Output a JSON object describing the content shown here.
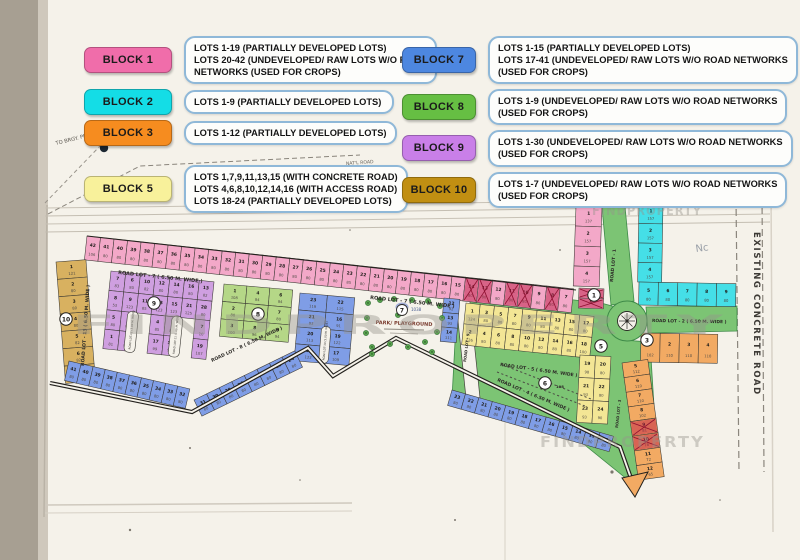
{
  "legend": {
    "left": [
      {
        "block": "BLOCK 1",
        "color": "#f06daa",
        "lines": [
          "LOTS 1-19  (PARTIALLY DEVELOPED LOTS)",
          "LOTS 20-42 (UNDEVELOPED/ RAW LOTS W/O ROAD",
          "NETWORKS (USED FOR CROPS)"
        ]
      },
      {
        "block": "BLOCK 2",
        "color": "#14dde6",
        "lines": [
          "LOTS 1-9   (PARTIALLY DEVELOPED LOTS)"
        ]
      },
      {
        "block": "BLOCK 3",
        "color": "#f68c1f",
        "lines": [
          "LOTS 1-12  (PARTIALLY DEVELOPED LOTS)"
        ]
      },
      {
        "block": "BLOCK 5",
        "color": "#f8f19b",
        "lines": [
          "LOTS 1,7,9,11,13,15 (WITH CONCRETE ROAD)",
          "LOTS 4,6,8,10,12,14,16 (WITH ACCESS ROAD)",
          "LOTS 18-24 (PARTIALLY DEVELOPED LOTS)"
        ]
      }
    ],
    "right": [
      {
        "block": "BLOCK 7",
        "color": "#4d87e0",
        "lines": [
          "LOTS 1-15  (PARTIALLY DEVELOPED LOTS)",
          "LOTS 17-41 (UNDEVELOPED/ RAW LOTS W/O ROAD NETWORKS",
          "(USED FOR CROPS)"
        ]
      },
      {
        "block": "BLOCK 8",
        "color": "#66bf43",
        "lines": [
          "LOTS 1-9 (UNDEVELOPED/ RAW LOTS W/O ROAD NETWORKS",
          "(USED FOR CROPS)"
        ]
      },
      {
        "block": "BLOCK 9",
        "color": "#c97fe8",
        "lines": [
          "LOTS 1-30 (UNDEVELOPED/ RAW LOTS W/O ROAD NETWORKS",
          "(USED FOR CROPS)"
        ]
      },
      {
        "block": "BLOCK 10",
        "color": "#c18f12",
        "lines": [
          "LOTS 1-7 (UNDEVELOPED/ RAW LOTS W/O ROAD NETWORKS",
          "(USED FOR CROPS)"
        ]
      }
    ]
  },
  "map": {
    "labels": {
      "road_lot_1": "ROAD LOT - 1",
      "road_lot_2": "ROAD LOT - 2  ( 6.50 M. WIDE )",
      "road_lot_3": "ROAD LOT - 3",
      "road_lot_4": "ROAD LOT - 4  ( 6.50 M. WIDE )",
      "road_lot_5": "ROAD LOT - 5  ( 6.50 M. WIDE )",
      "road_lot_7": "ROAD LOT - 7  ( 6.50 M. WIDE )",
      "road_lot_8": "ROAD LOT - 8  ( 6.50 M. WIDE )",
      "road_lot_9": "ROAD LOT - 9",
      "road_lot_10": "ROAD LOT-10 (3.00 M. WIDE)",
      "road_lot_11": "ROAD LOT-11 (3.00 M. WIDE)",
      "road_lot_12": "ROAD LOT-12 (3.00 M. WIDE)",
      "road_lot_13": "ROAD LOT - 13  ( 6.50 M. WIDE )",
      "existing_road": "EXISTING CONCRETE ROAD",
      "national_road": "NAT'L ROAD",
      "to_proper": "TO BRGY. PROPER",
      "park": "PARK/ PLAYGROUND",
      "park_area": "1038",
      "access_area": "108",
      "pencil_note": "Nc",
      "watermark": "FINDPROPERTY"
    },
    "circles": {
      "block1": "1",
      "block3": "3",
      "block5": "5",
      "block6": "6",
      "block7": "7",
      "block8": "8",
      "block9": "9",
      "block10": "10"
    },
    "block_colors": {
      "1": "#f3a8c8",
      "2": "#45dfe7",
      "3": "#f2aa63",
      "5": "#f3e695",
      "7": "#7f9de6",
      "8": "#b5d787",
      "9": "#cf9fe0",
      "10": "#d8b160"
    },
    "road_green": "#7cc474",
    "strips": [
      {
        "id": "pink-top",
        "block": "1",
        "lots": [
          "42|106",
          "41|80",
          "40|80",
          "39|80",
          "38|80",
          "37|80",
          "36|80",
          "35|80",
          "34|80",
          "33|80",
          "32|80",
          "31|80",
          "30|80",
          "29|80",
          "28|80",
          "27|80",
          "26|80",
          "25|80",
          "24|80",
          "23|85",
          "22|80",
          "21|80",
          "20|80",
          "19|80",
          "18|80",
          "17|80",
          "16|80",
          "15|80",
          "14|80",
          "13|80",
          "12|80",
          "11|80",
          "10|80",
          "9|80",
          "8|80",
          "7|80"
        ],
        "marked": [
          "14",
          "13",
          "11",
          "10",
          "8"
        ]
      },
      {
        "id": "pink-col",
        "block": "1",
        "lots": [
          "1|137",
          "2|157",
          "3|157",
          "4|157"
        ]
      },
      {
        "id": "pink-col-sm",
        "block": "1",
        "lots": [
          "5|",
          "6|"
        ],
        "marked": [
          "5",
          "6"
        ]
      },
      {
        "id": "gold-col",
        "block": "10",
        "lots": [
          "1|121",
          "2|80",
          "3|80",
          "4|80",
          "5|82",
          "6|82",
          "7|80"
        ]
      },
      {
        "id": "purple",
        "block": "9",
        "rows": [
          [
            "7|83",
            "6|80",
            "10|82",
            "12|80",
            "14|80",
            "16|80",
            "13|82"
          ],
          [
            "8|53",
            "9|123",
            "11|85",
            "13|123",
            "15|123",
            "21|125",
            "28|80"
          ],
          [
            "5|80",
            "3|85",
            null,
            "4|85",
            "6|85",
            null,
            "7|10"
          ],
          [
            "1|81",
            "2|99",
            null,
            "17|99",
            "18|99",
            null,
            "19|107"
          ]
        ]
      },
      {
        "id": "green8",
        "block": "8",
        "rows": [
          [
            "1|108",
            "4|84",
            "6|84"
          ],
          [
            "2|80",
            "5|111",
            "7|80"
          ],
          [
            "3|100",
            "8|96",
            "9|94"
          ]
        ]
      },
      {
        "id": "blue-park",
        "block": "7",
        "rows": [
          [
            "23|119",
            "22|115"
          ],
          [
            "21|93",
            "16|91"
          ],
          [
            "20|113",
            "19|122"
          ],
          [
            "18|122",
            "17|109"
          ]
        ]
      },
      {
        "id": "park-right",
        "block": "7",
        "lots": [
          "12|92",
          "13|93",
          "14|111"
        ]
      },
      {
        "id": "yellow-main",
        "block": "5",
        "rows": [
          [
            "1|124",
            "3|80",
            "5|80",
            "7|80",
            "9|80",
            "11|80",
            "13|80",
            "15|80",
            "17|80"
          ],
          [
            "2|126",
            "4|80",
            "6|80",
            "8|80",
            "10|80",
            "12|80",
            "14|80",
            "16|80",
            "18|100"
          ]
        ]
      },
      {
        "id": "yellow-col",
        "block": "5",
        "rows": [
          [
            "19|98",
            "20|80"
          ],
          [
            "21|93",
            "22|80"
          ],
          [
            "23|93",
            "24|90"
          ]
        ]
      },
      {
        "id": "blue-right",
        "block": "7",
        "lots": [
          "23|80",
          "22|80",
          "21|80",
          "20|80",
          "19|80",
          "18|80",
          "17|80",
          "16|80",
          "15|80",
          "14|80",
          "13|80",
          "12|80"
        ]
      },
      {
        "id": "blue-bl",
        "block": "7",
        "lots": [
          "41|80",
          "40|80",
          "39|80",
          "38|80",
          "37|80",
          "36|80",
          "35|80",
          "34|80",
          "33|80",
          "32|80"
        ]
      },
      {
        "id": "blue-rise",
        "block": "7",
        "lots": [
          "31|80",
          "30|80",
          "29|80",
          "28|80",
          "27|80",
          "26|80",
          "25|80",
          "24|80"
        ]
      },
      {
        "id": "cyan-col",
        "block": "2",
        "lots": [
          "1|157",
          "2|157",
          "3|157",
          "4|157"
        ]
      },
      {
        "id": "cyan-row",
        "block": "2",
        "lots": [
          "5|80",
          "6|80",
          "7|80",
          "8|80",
          "9|80"
        ]
      },
      {
        "id": "orange-row",
        "block": "3",
        "lots": [
          "1|102",
          "2|110",
          "3|110",
          "4|110"
        ]
      },
      {
        "id": "orange-col",
        "block": "3",
        "lots": [
          "5|112",
          "6|110",
          "7|110",
          "8|102",
          "9|81",
          "10|78",
          "11|72",
          "12|65"
        ],
        "marked": [
          "9",
          "10"
        ]
      }
    ]
  }
}
